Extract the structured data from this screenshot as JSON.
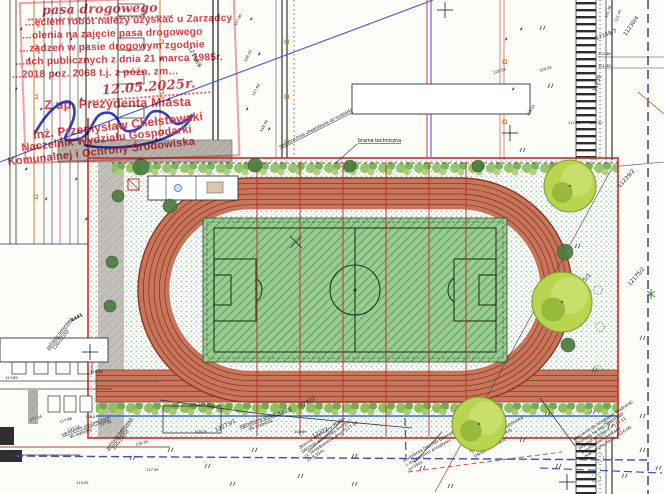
{
  "stamp": {
    "hw_line": "pasa  drogowego",
    "line2": "…ęciem robót należy uzyskać u Zarządcy",
    "line3": "…olenia na zajęcie pasa drogowego",
    "line4": "…ządzeń w pasie drogowym zgodnie",
    "line5": "…ach publicznych z dnia 21 marca 1985r.",
    "line6": "…2018 poz. 2068 t.j. z późn. zm…",
    "date_hw": "12.05.2025r.",
    "authority": "Z up. Prezydenta Miasta",
    "signer_name": "inż. Przemysław Chełstowski",
    "signer_title1": "Naczelnik Wydziału Gospodarki",
    "signer_title2": "Komunalnej i Ochrony Środowiska"
  },
  "colors": {
    "track": "#c9755a",
    "track_line": "#7a2f1f",
    "pitch": "#9bcd92",
    "pitch_line": "#1e3a1e",
    "boundary_red": "#cc2a2a",
    "stamp_red": "#e23b47",
    "ink_blue": "#2733c6",
    "water_blue": "#3d4cc0",
    "utility_orange": "#c87f2e",
    "tree_green": "#b9d44e"
  },
  "map": {
    "labels": {
      "brama": "brama techniczna",
      "nawierzchnia": "nawierzchnia utwardzona do rozbiórki",
      "ogrodzenie_l1": "ogrodzenie przeznaczone",
      "ogrodzenie_l2": "do rozbiórki",
      "palisada1_l1": "palisada betonowa",
      "palisada1_l2": "120x12x50",
      "palisada2_l1": "palisada betonowa",
      "palisada2_l2": "200x12x50",
      "num_4441": "4441"
    },
    "parcels": [
      {
        "t": "12169/8",
        "x": 188,
        "y": 48,
        "r": 62
      },
      {
        "t": "12169/7",
        "x": 596,
        "y": 40,
        "r": -20
      },
      {
        "t": "11230/4",
        "x": 626,
        "y": 36,
        "r": -55
      },
      {
        "t": "11230",
        "x": 596,
        "y": 92,
        "r": -72
      },
      {
        "t": "11239/2",
        "x": 620,
        "y": 188,
        "r": -48
      },
      {
        "t": "12175/1",
        "x": 576,
        "y": 292,
        "r": -48
      },
      {
        "t": "12175/2",
        "x": 630,
        "y": 286,
        "r": -48
      },
      {
        "t": "12273/1",
        "x": 216,
        "y": 432,
        "r": -26
      },
      {
        "t": "12222",
        "x": 301,
        "y": 408,
        "r": -30
      },
      {
        "t": "12272",
        "x": 313,
        "y": 438,
        "r": -26
      }
    ],
    "elevations": [
      {
        "t": "117.80",
        "x": 236,
        "y": 26,
        "r": -62
      },
      {
        "t": "118.02",
        "x": 246,
        "y": 62,
        "r": -62
      },
      {
        "t": "117.64",
        "x": 254,
        "y": 96,
        "r": -62
      },
      {
        "t": "118.49",
        "x": 262,
        "y": 132,
        "r": -62
      },
      {
        "t": "121.36",
        "x": 607,
        "y": 18,
        "r": -70
      },
      {
        "t": "121.41",
        "x": 617,
        "y": 22,
        "r": -70
      },
      {
        "t": "120.36",
        "x": 598,
        "y": 55,
        "r": 0
      },
      {
        "t": "121.36",
        "x": 598,
        "y": 67,
        "r": 0
      },
      {
        "t": "120.53",
        "x": 494,
        "y": 74,
        "r": -18
      },
      {
        "t": "120.63",
        "x": 540,
        "y": 72,
        "r": -18
      },
      {
        "t": "118.45",
        "x": 528,
        "y": 116,
        "r": -55
      },
      {
        "t": "117.94",
        "x": 568,
        "y": 124,
        "r": 0
      },
      {
        "t": "117.90",
        "x": 590,
        "y": 124,
        "r": 0
      },
      {
        "t": "119.36",
        "x": 90,
        "y": 373,
        "r": 0
      },
      {
        "t": "117.69",
        "x": 5,
        "y": 379,
        "r": 0
      },
      {
        "t": "117.54",
        "x": 30,
        "y": 421,
        "r": -16
      },
      {
        "t": "117.88",
        "x": 60,
        "y": 423,
        "r": -16
      },
      {
        "t": "117.52",
        "x": 68,
        "y": 431,
        "r": -16
      },
      {
        "t": "118.0",
        "x": 85,
        "y": 418,
        "r": 0
      },
      {
        "t": "117.81",
        "x": 100,
        "y": 426,
        "r": -16
      },
      {
        "t": "118.36",
        "x": 136,
        "y": 446,
        "r": -16
      },
      {
        "t": "119.05",
        "x": 76,
        "y": 484,
        "r": 0
      },
      {
        "t": "117.39",
        "x": 146,
        "y": 471,
        "r": 0
      },
      {
        "t": "118.14",
        "x": 198,
        "y": 405,
        "r": 0
      },
      {
        "t": "118.29",
        "x": 194,
        "y": 433,
        "r": 0
      },
      {
        "t": "118.69",
        "x": 294,
        "y": 433,
        "r": 0
      }
    ],
    "notes": [
      {
        "x": 300,
        "y": 449,
        "r": -33,
        "lines": [
          "zbiornik retencyjny PEHD",
          "DN1500 deszczowy V=15m³",
          "rz. posadowienia dna: *117.34",
          "L=8.55m"
        ]
      },
      {
        "x": 404,
        "y": 462,
        "r": -30,
        "lines": [
          "studzienka DN1500 betonowa",
          "z regulatorem przepływu",
          "q=15l/s"
        ]
      },
      {
        "x": 470,
        "y": 449,
        "r": -30,
        "lines": [
          "studzienka DN1000 betonowa",
          "z osadnikiem h=70cm",
          "DN160 na ścianie"
        ]
      },
      {
        "x": 574,
        "y": 441,
        "r": -33,
        "lines": [
          "włączenie do istniejącej studzienki",
          "zbiorczej na sieci kd/D1000",
          "poprzez wcinkę rz. *117.11",
          "z wyłożeniem kaskady",
          "zewnętrznej na rz. *116.00"
        ]
      }
    ],
    "grass": [
      [
        168,
        452
      ],
      [
        205,
        468
      ],
      [
        252,
        452
      ],
      [
        298,
        478
      ],
      [
        352,
        458
      ],
      [
        420,
        470
      ],
      [
        448,
        488
      ],
      [
        520,
        442
      ],
      [
        556,
        468
      ],
      [
        608,
        428
      ],
      [
        640,
        452
      ],
      [
        622,
        478
      ],
      [
        590,
        414
      ],
      [
        545,
        416
      ],
      [
        352,
        486
      ],
      [
        230,
        486
      ],
      [
        130,
        460
      ],
      [
        495,
        432
      ],
      [
        640,
        418
      ],
      [
        656,
        470
      ],
      [
        540,
        30
      ],
      [
        548,
        88
      ],
      [
        520,
        152
      ],
      [
        575,
        248
      ],
      [
        592,
        372
      ],
      [
        640,
        340
      ]
    ],
    "rings": [
      [
        598,
        290
      ],
      [
        600,
        327
      ],
      [
        598,
        370
      ],
      [
        601,
        432
      ],
      [
        599,
        458
      ],
      [
        596,
        478
      ]
    ],
    "bz": [
      {
        "t": "Bz",
        "x": 590,
        "y": 160
      },
      {
        "t": "Bz",
        "x": 604,
        "y": 424
      }
    ],
    "trees": [
      {
        "x": 570,
        "y": 186,
        "r": 26
      },
      {
        "x": 562,
        "y": 302,
        "r": 30
      },
      {
        "x": 479,
        "y": 424,
        "r": 27
      }
    ],
    "bushes": [
      [
        141,
        167,
        8
      ],
      [
        170,
        206,
        7
      ],
      [
        118,
        196,
        6
      ],
      [
        255,
        165,
        7
      ],
      [
        350,
        166,
        6
      ],
      [
        478,
        166,
        6
      ],
      [
        112,
        262,
        6
      ],
      [
        110,
        306,
        6
      ],
      [
        565,
        252,
        8
      ],
      [
        568,
        345,
        7
      ]
    ],
    "crosses": [
      [
        445,
        10,
        0
      ],
      [
        510,
        133,
        0
      ],
      [
        90,
        352,
        0
      ],
      [
        567,
        482,
        0
      ],
      [
        296,
        242,
        1
      ]
    ],
    "specks": [
      [
        20,
        30
      ],
      [
        28,
        60
      ],
      [
        15,
        90
      ],
      [
        40,
        110
      ],
      [
        55,
        75
      ],
      [
        70,
        40
      ],
      [
        80,
        100
      ],
      [
        60,
        140
      ],
      [
        25,
        170
      ],
      [
        45,
        200
      ],
      [
        75,
        180
      ],
      [
        85,
        220
      ],
      [
        250,
        20
      ],
      [
        258,
        55
      ],
      [
        246,
        110
      ],
      [
        268,
        130
      ],
      [
        160,
        60
      ],
      [
        168,
        100
      ],
      [
        155,
        140
      ],
      [
        505,
        40
      ],
      [
        512,
        90
      ],
      [
        520,
        30
      ]
    ],
    "osquares": [
      [
        34,
        45
      ],
      [
        34,
        95
      ],
      [
        34,
        145
      ],
      [
        34,
        195
      ],
      [
        160,
        40
      ],
      [
        160,
        90
      ],
      [
        160,
        130
      ],
      [
        285,
        40
      ],
      [
        285,
        95
      ],
      [
        285,
        140
      ],
      [
        503,
        60
      ],
      [
        503,
        120
      ]
    ],
    "red_lines_x": [
      257,
      300,
      343,
      386,
      429,
      466
    ],
    "star": [
      [
        651,
        294
      ]
    ]
  }
}
